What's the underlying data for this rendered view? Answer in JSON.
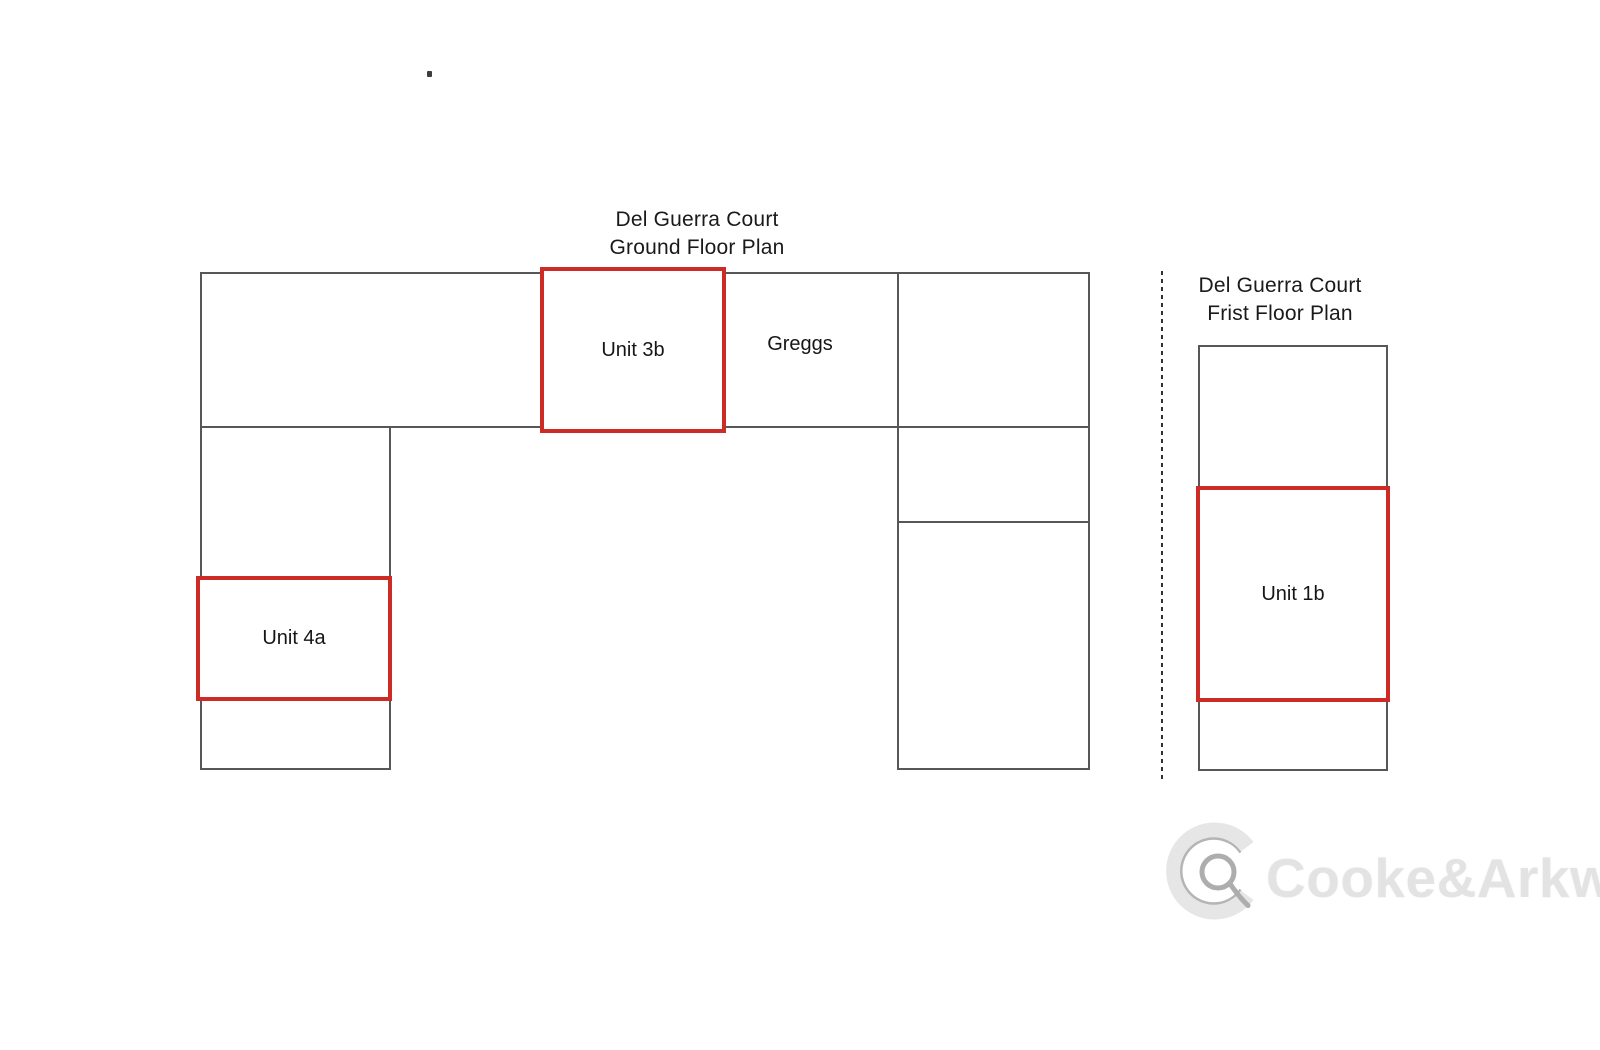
{
  "page": {
    "background": "#ffffff"
  },
  "ground_floor_plan": {
    "title_line1": "Del Guerra Court",
    "title_line2": "Ground Floor Plan",
    "unit_3b_label": "Unit 3b",
    "greggs_label": "Greggs",
    "unit_4a_label": "Unit 4a"
  },
  "first_floor_plan": {
    "title_line1": "Del Guerra Court",
    "title_line2": "Frist Floor Plan",
    "unit_1b_label": "Unit 1b"
  },
  "watermark": {
    "brand_text": "Cooke&Arkwright",
    "logo_icon": "cooke-arkwright-ca-monogram-icon"
  },
  "colors": {
    "plan_outline_gray": "#575757",
    "unit_highlight_red": "#cc2b26",
    "label_text": "#161616",
    "dashed_line": "#333333",
    "watermark_gray": "#e3e3e3"
  }
}
